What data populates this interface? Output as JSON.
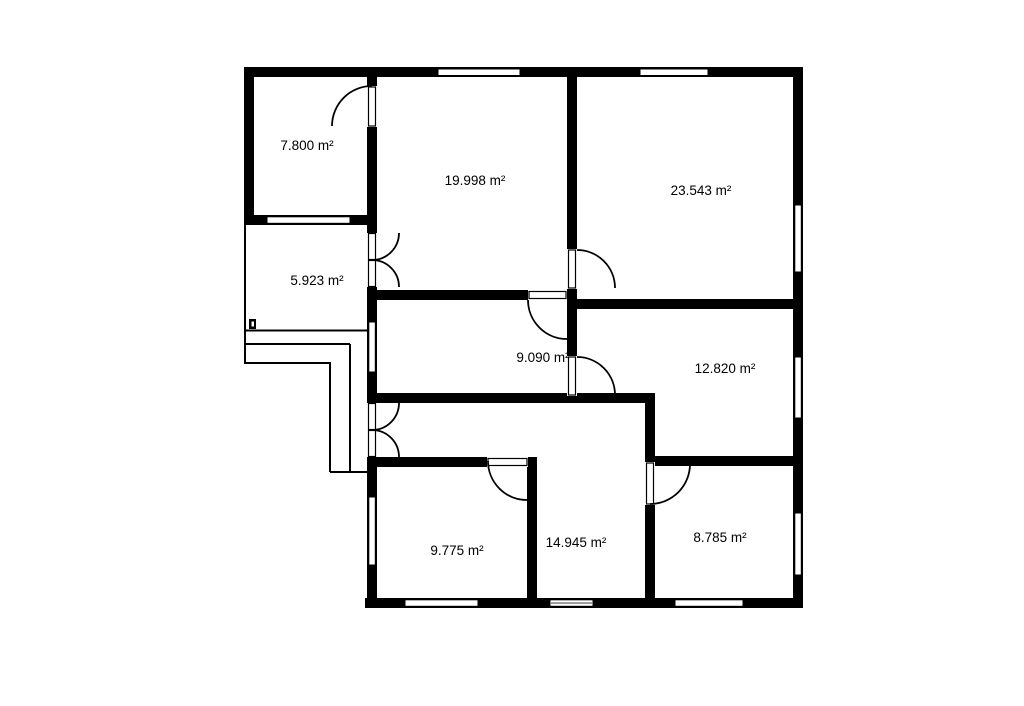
{
  "canvas": {
    "width": 1024,
    "height": 701,
    "background": "#ffffff",
    "ink": "#000000"
  },
  "rooms": [
    {
      "id": "room-7-800",
      "label": "7.800 m²",
      "label_x": 307,
      "label_y": 150
    },
    {
      "id": "balcony-5-923",
      "label": "5.923 m²",
      "label_x": 317,
      "label_y": 285
    },
    {
      "id": "room-19-998",
      "label": "19.998 m²",
      "label_x": 475,
      "label_y": 185
    },
    {
      "id": "room-23-543",
      "label": "23.543 m²",
      "label_x": 701,
      "label_y": 195
    },
    {
      "id": "room-9-090",
      "label": "9.090 m²",
      "label_x": 543,
      "label_y": 362
    },
    {
      "id": "room-12-820",
      "label": "12.820 m²",
      "label_x": 725,
      "label_y": 373
    },
    {
      "id": "room-9-775",
      "label": "9.775 m²",
      "label_x": 457,
      "label_y": 555
    },
    {
      "id": "hall-14-945",
      "label": "14.945 m²",
      "label_x": 576,
      "label_y": 547
    },
    {
      "id": "room-8-785",
      "label": "8.785 m²",
      "label_x": 720,
      "label_y": 542
    }
  ],
  "walls": [
    {
      "name": "wall-outer-top",
      "x": 244,
      "y": 67,
      "w": 559,
      "h": 10
    },
    {
      "name": "wall-outer-right",
      "x": 793,
      "y": 67,
      "w": 10,
      "h": 541
    },
    {
      "name": "wall-outer-bottom",
      "x": 365,
      "y": 598,
      "w": 438,
      "h": 10
    },
    {
      "name": "wall-outer-left",
      "x": 244,
      "y": 67,
      "w": 10,
      "h": 158
    },
    {
      "name": "wall-bedroom-bottom",
      "x": 244,
      "y": 215,
      "w": 133,
      "h": 10
    },
    {
      "name": "wall-spine-left",
      "x": 367,
      "y": 67,
      "w": 10,
      "h": 541
    },
    {
      "name": "wall-center-vertical",
      "x": 567,
      "y": 67,
      "w": 10,
      "h": 336
    },
    {
      "name": "wall-living-bottom",
      "x": 367,
      "y": 290,
      "w": 210,
      "h": 10
    },
    {
      "name": "wall-room23-bottom",
      "x": 567,
      "y": 299,
      "w": 236,
      "h": 10
    },
    {
      "name": "wall-hall-top",
      "x": 367,
      "y": 393,
      "w": 288,
      "h": 10
    },
    {
      "name": "wall-hall-right",
      "x": 645,
      "y": 393,
      "w": 10,
      "h": 215
    },
    {
      "name": "wall-room9775-top",
      "x": 367,
      "y": 457,
      "w": 170,
      "h": 10
    },
    {
      "name": "wall-room12820-bottom",
      "x": 648,
      "y": 456,
      "w": 155,
      "h": 10
    },
    {
      "name": "wall-room9775-right",
      "x": 527,
      "y": 457,
      "w": 10,
      "h": 151
    }
  ],
  "thin_lines": [
    {
      "name": "balcony-rail-left",
      "x1": 245,
      "y1": 224,
      "x2": 245,
      "y2": 364
    },
    {
      "name": "balcony-rail-bottom",
      "x1": 244,
      "y1": 330.5,
      "x2": 367,
      "y2": 330.5
    },
    {
      "name": "stair-step-1",
      "x1": 244,
      "y1": 344,
      "x2": 350,
      "y2": 344
    },
    {
      "name": "stair-step-2",
      "x1": 244,
      "y1": 363,
      "x2": 331,
      "y2": 363
    },
    {
      "name": "stair-side-inner",
      "x1": 330,
      "y1": 363,
      "x2": 330,
      "y2": 472
    },
    {
      "name": "stair-side-outer",
      "x1": 350,
      "y1": 344,
      "x2": 350,
      "y2": 472
    },
    {
      "name": "stair-bottom",
      "x1": 330,
      "y1": 472,
      "x2": 368,
      "y2": 472
    }
  ],
  "entry_marker": {
    "name": "balcony-gate-marker",
    "outer": {
      "x": 249,
      "y": 319,
      "w": 7,
      "h": 10
    },
    "inner": {
      "x": 251.5,
      "y": 321.5,
      "w": 2.5,
      "h": 5
    }
  },
  "windows": [
    {
      "name": "window-top-living",
      "x": 438,
      "y": 69,
      "w": 82,
      "h": 6.5,
      "style": "plain"
    },
    {
      "name": "window-top-room23",
      "x": 640,
      "y": 69,
      "w": 68,
      "h": 6.5,
      "style": "plain"
    },
    {
      "name": "window-bedroom-balcony",
      "x": 267,
      "y": 216.8,
      "w": 83,
      "h": 6.5,
      "style": "plain"
    },
    {
      "name": "window-right-room23",
      "x": 794.8,
      "y": 205,
      "w": 6.5,
      "h": 67,
      "style": "plain"
    },
    {
      "name": "window-right-room12820",
      "x": 794.8,
      "y": 357,
      "w": 6.5,
      "h": 61,
      "style": "plain"
    },
    {
      "name": "window-right-room8785",
      "x": 794.8,
      "y": 513,
      "w": 6.5,
      "h": 62,
      "style": "plain"
    },
    {
      "name": "window-left-room9090",
      "x": 368.8,
      "y": 322,
      "w": 6.5,
      "h": 50,
      "style": "plain"
    },
    {
      "name": "window-left-room9775",
      "x": 368.8,
      "y": 497,
      "w": 6.5,
      "h": 68,
      "style": "plain"
    },
    {
      "name": "window-bottom-room9775",
      "x": 405,
      "y": 599.8,
      "w": 73,
      "h": 6.5,
      "style": "plain"
    },
    {
      "name": "window-bottom-hall",
      "x": 550,
      "y": 599.8,
      "w": 43,
      "h": 6.5,
      "style": "double"
    },
    {
      "name": "window-bottom-room8785",
      "x": 675,
      "y": 599.8,
      "w": 68,
      "h": 6.5,
      "style": "plain"
    }
  ],
  "doors": [
    {
      "name": "door-room7800",
      "gap": {
        "x": 367,
        "y": 86,
        "w": 10,
        "h": 41
      },
      "leaves": [
        {
          "x": 368.5,
          "y": 87,
          "w": 7,
          "h": 39
        }
      ],
      "arcs": [
        "M 372 86 A 40 40 0 0 0 332 126"
      ]
    },
    {
      "name": "double-door-balcony",
      "gap": {
        "x": 367,
        "y": 233,
        "w": 10,
        "h": 54
      },
      "leaves": [
        {
          "x": 368.5,
          "y": 233.5,
          "w": 7,
          "h": 26
        },
        {
          "x": 368.5,
          "y": 260.5,
          "w": 7,
          "h": 26
        }
      ],
      "arcs": [
        "M 372 260 A 27 27 0 0 0 399 233",
        "M 372 260 A 27 27 0 0 1 399 287"
      ]
    },
    {
      "name": "double-door-entrance",
      "gap": {
        "x": 367,
        "y": 403,
        "w": 10,
        "h": 54
      },
      "leaves": [
        {
          "x": 368.5,
          "y": 403.5,
          "w": 7,
          "h": 26
        },
        {
          "x": 368.5,
          "y": 430.5,
          "w": 7,
          "h": 26
        }
      ],
      "arcs": [
        "M 372 430 A 27 27 0 0 0 399 403",
        "M 372 430 A 27 27 0 0 1 399 457"
      ]
    },
    {
      "name": "door-living-to-room9090",
      "gap": {
        "x": 528,
        "y": 290,
        "w": 39,
        "h": 10
      },
      "leaves": [
        {
          "x": 529,
          "y": 291.5,
          "w": 37,
          "h": 7
        }
      ],
      "arcs": [
        "M 528 300 A 39 39 0 0 0 567 339"
      ]
    },
    {
      "name": "door-room23543",
      "gap": {
        "x": 567,
        "y": 249,
        "w": 10,
        "h": 40
      },
      "leaves": [
        {
          "x": 568.5,
          "y": 250,
          "w": 7,
          "h": 38
        }
      ],
      "arcs": [
        "M 577 250 A 38 38 0 0 1 615 288"
      ]
    },
    {
      "name": "door-room12820",
      "gap": {
        "x": 567,
        "y": 356,
        "w": 10,
        "h": 40
      },
      "leaves": [
        {
          "x": 568.5,
          "y": 357,
          "w": 7,
          "h": 38
        }
      ],
      "arcs": [
        "M 577 357 A 38 38 0 0 1 615 395"
      ]
    },
    {
      "name": "door-room9775",
      "gap": {
        "x": 487,
        "y": 457,
        "w": 41,
        "h": 10
      },
      "leaves": [
        {
          "x": 488,
          "y": 458.5,
          "w": 39,
          "h": 7
        }
      ],
      "arcs": [
        "M 488 461 A 39 39 0 0 0 527 500"
      ]
    },
    {
      "name": "door-room8785",
      "gap": {
        "x": 645,
        "y": 462,
        "w": 10,
        "h": 43
      },
      "leaves": [
        {
          "x": 646.5,
          "y": 463,
          "w": 7,
          "h": 41
        }
      ],
      "arcs": [
        "M 690 464 A 40 40 0 0 1 650 504"
      ]
    }
  ]
}
